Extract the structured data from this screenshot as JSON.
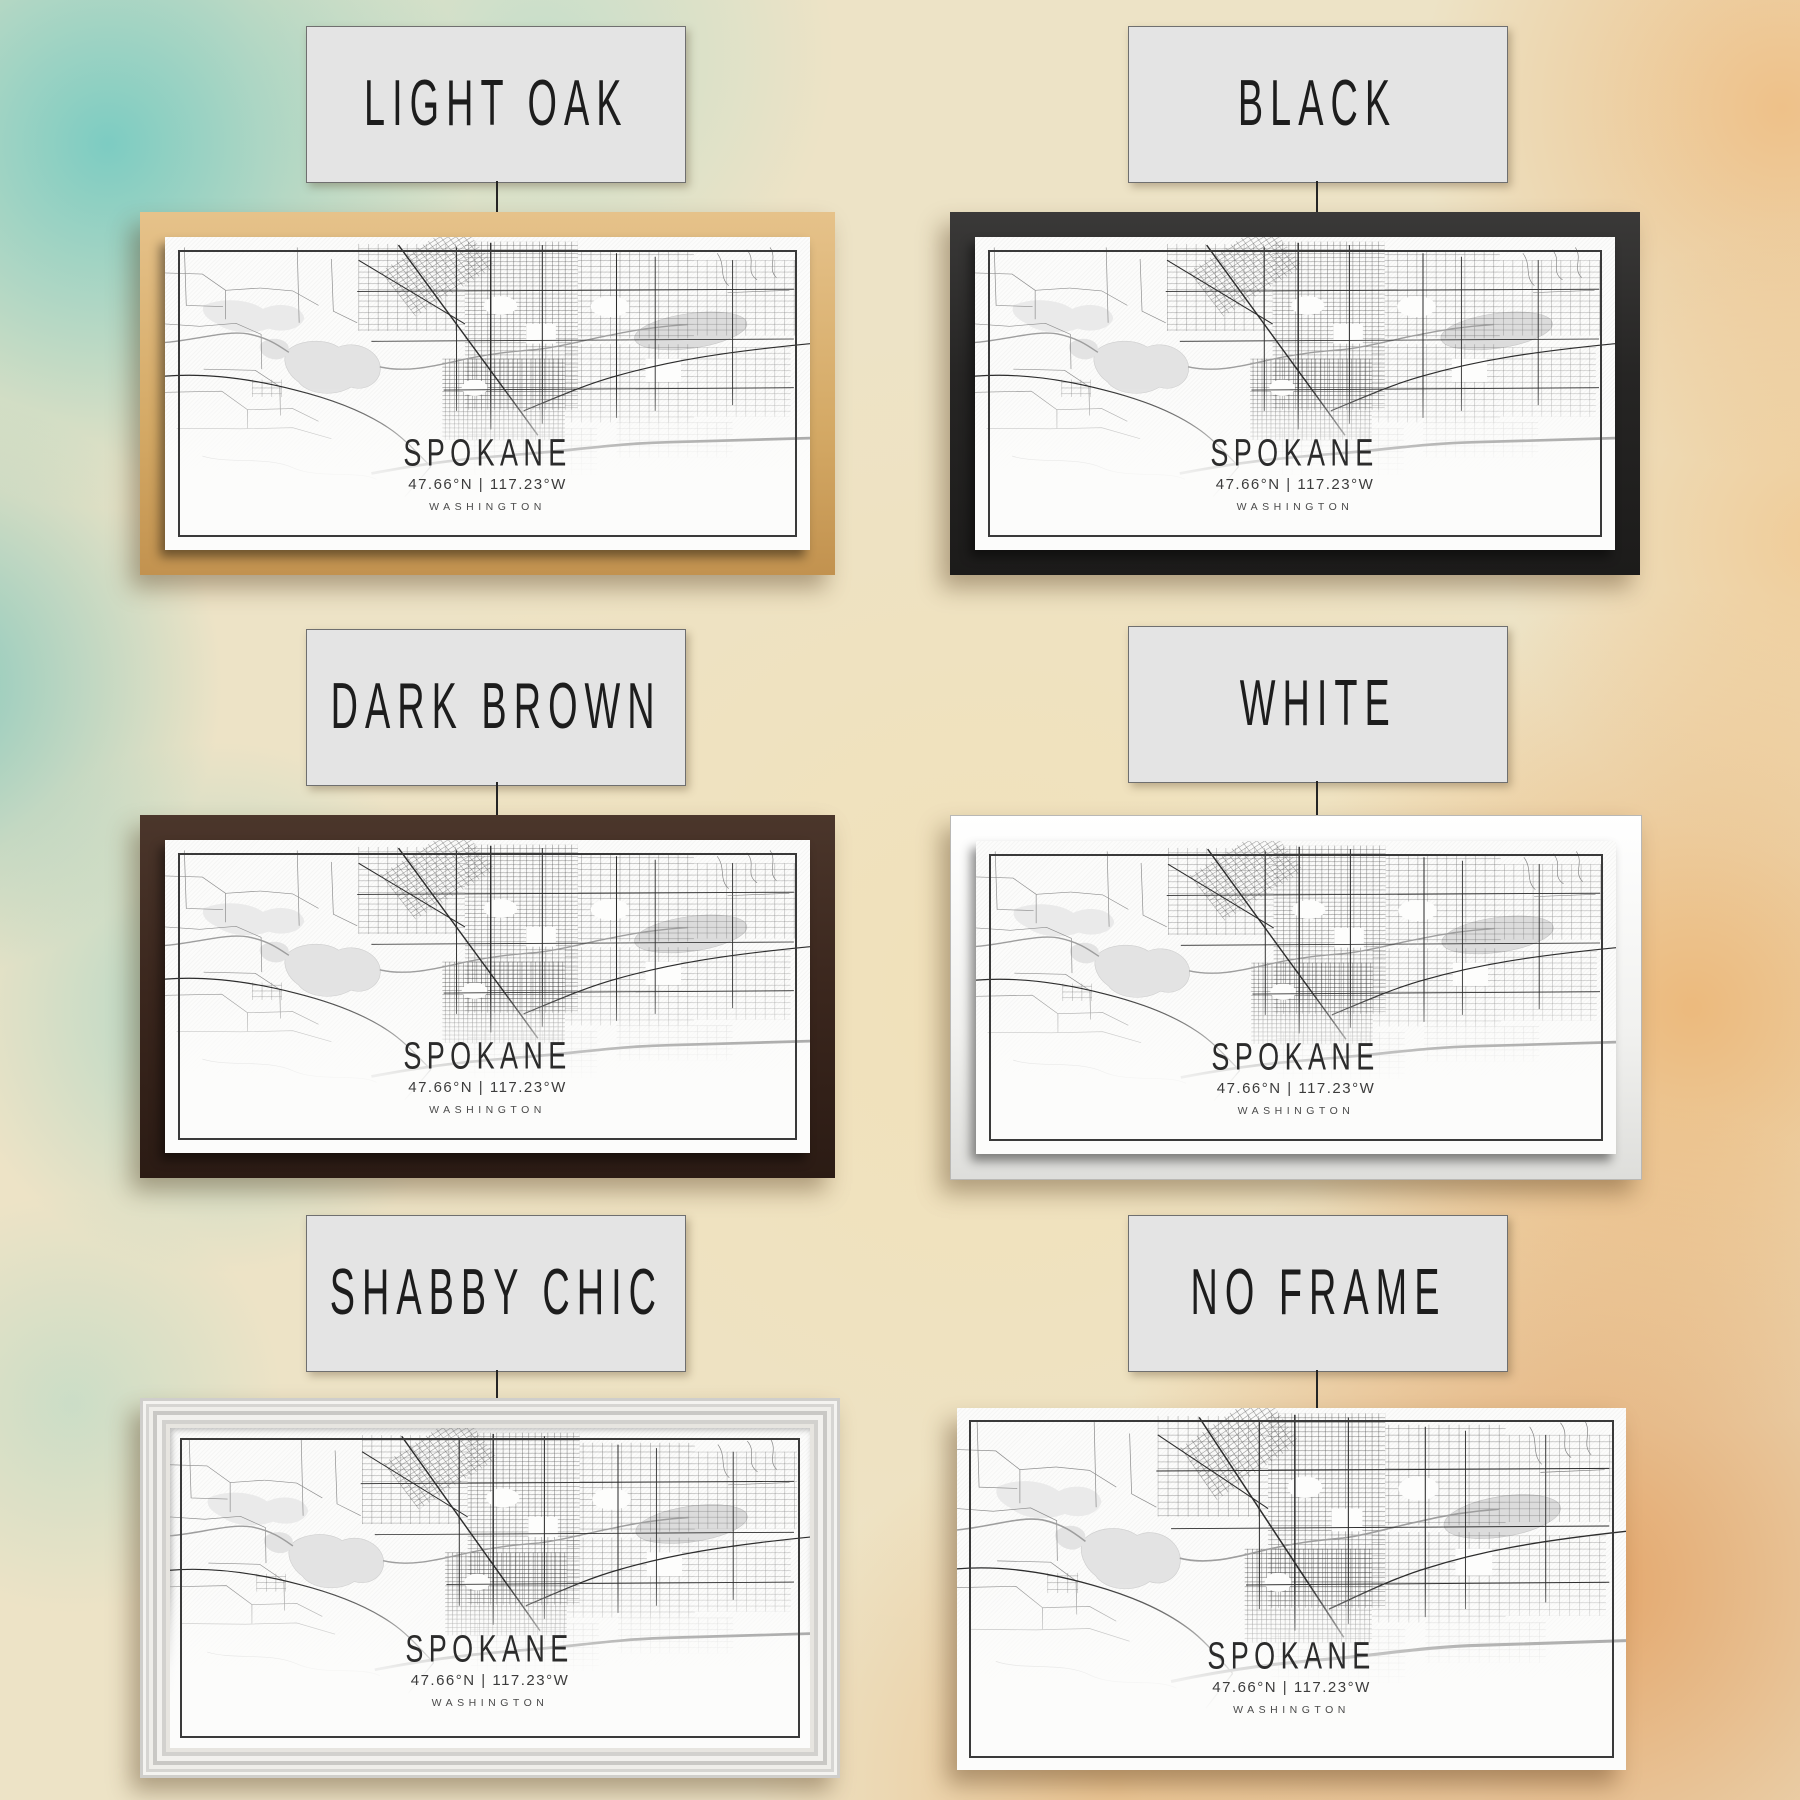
{
  "wall": {
    "style": "watercolor-texture",
    "teal_hex": "#69c8c1",
    "cream_hex": "#ede3c6",
    "rust_hex": "#de8032"
  },
  "print": {
    "city": "SPOKANE",
    "coordinates": "47.66°N | 117.23°W",
    "state": "WASHINGTON"
  },
  "options": [
    {
      "id": "light-oak",
      "label": "LIGHT OAK",
      "frame_color": "#d3a662"
    },
    {
      "id": "black",
      "label": "BLACK",
      "frame_color": "#262524"
    },
    {
      "id": "dark-brown",
      "label": "DARK BROWN",
      "frame_color": "#3a261d"
    },
    {
      "id": "white",
      "label": "WHITE",
      "frame_color": "#f1f1ef"
    },
    {
      "id": "shabby-chic",
      "label": "SHABBY CHIC",
      "frame_color": "#e7e5e0"
    },
    {
      "id": "no-frame",
      "label": "NO FRAME",
      "frame_color": null
    }
  ],
  "label_plaque": {
    "background": "#e4e4e4",
    "border": "#6f6f6f",
    "text_color": "#1d1d1d"
  }
}
